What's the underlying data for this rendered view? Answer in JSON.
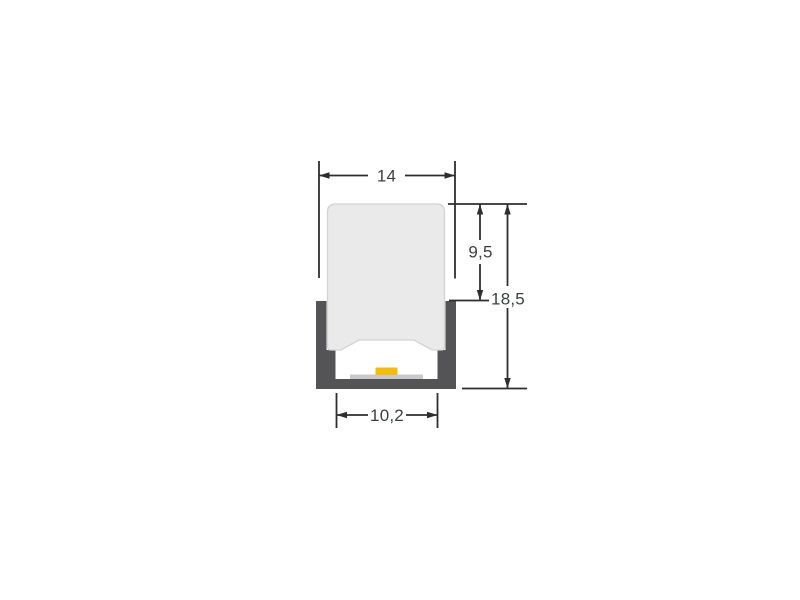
{
  "page": {
    "background": "#ffffff"
  },
  "drawing": {
    "kind": "cross-section technical drawing",
    "subject": "LED profile channel with diffuser and LED strip",
    "dims": {
      "outer_width": "14",
      "diffuser_height": "9,5",
      "total_height": "18,5",
      "inner_width": "10,2"
    },
    "colors": {
      "channel": "#545457",
      "diffuser_fill": "#eaeaea",
      "diffuser_stroke": "#d3d3d1",
      "pcb": "#c9c9c9",
      "led": "#f0bd0d",
      "dim_line": "#2e2e2e",
      "dim_text": "#3c3f44"
    }
  }
}
